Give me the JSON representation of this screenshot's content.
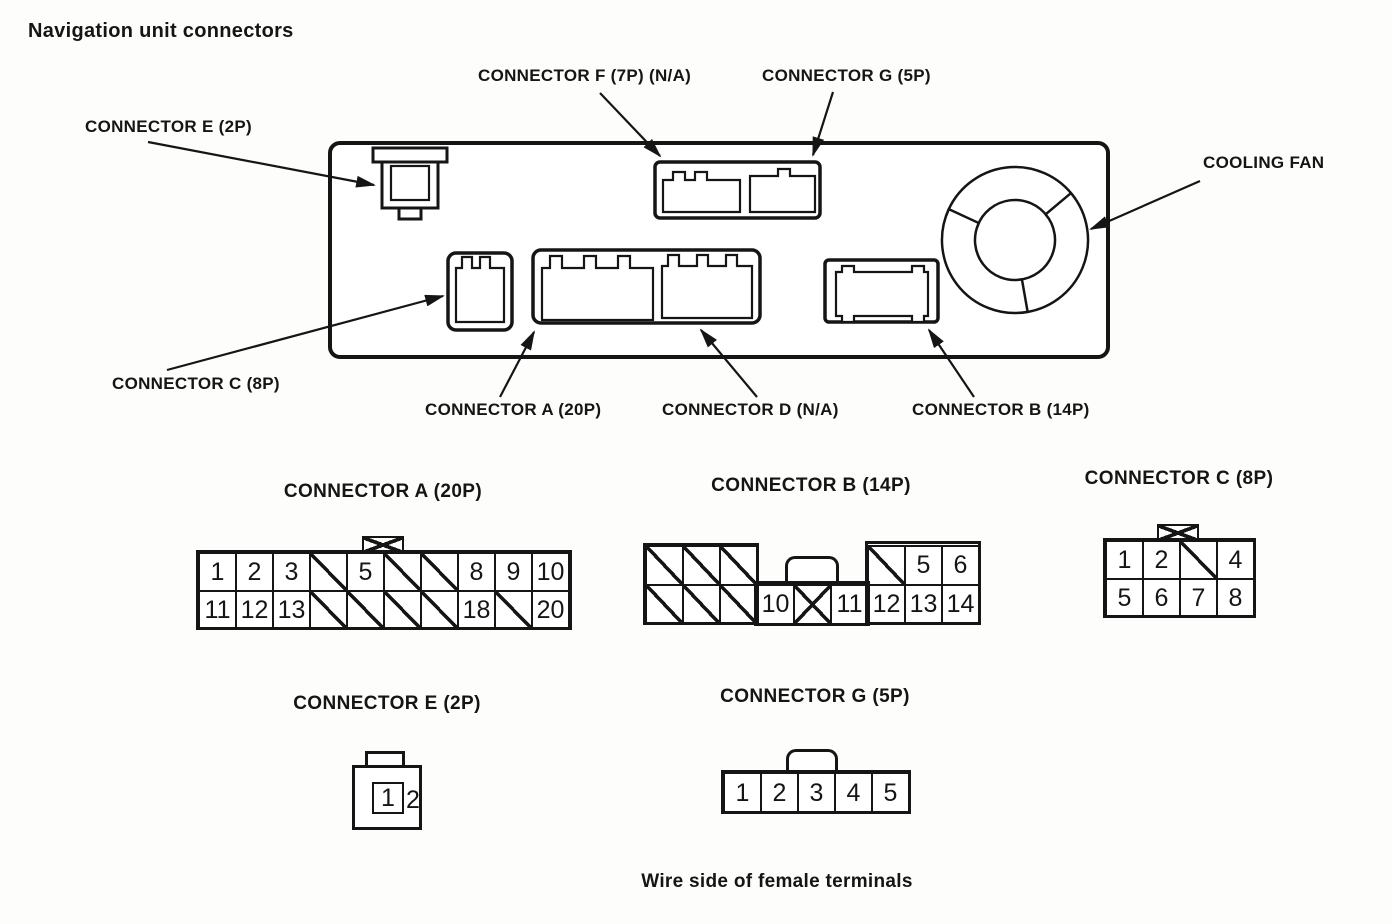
{
  "page_title": "Navigation unit connectors",
  "footer_note": "Wire side of female terminals",
  "unit_diagram": {
    "labels": {
      "e": "CONNECTOR E (2P)",
      "f": "CONNECTOR F (7P) (N/A)",
      "g": "CONNECTOR G (5P)",
      "cooling_fan": "COOLING FAN",
      "c": "CONNECTOR C (8P)",
      "a": "CONNECTOR A (20P)",
      "d": "CONNECTOR D (N/A)",
      "b": "CONNECTOR B (14P)"
    }
  },
  "pinouts": {
    "a": {
      "title": "CONNECTOR A (20P)",
      "rows": [
        [
          "1",
          "2",
          "3",
          "/",
          "5",
          "/",
          "/",
          "8",
          "9",
          "10"
        ],
        [
          "11",
          "12",
          "13",
          "/",
          "/",
          "/",
          "/",
          "18",
          "/",
          "20"
        ]
      ]
    },
    "b": {
      "title": "CONNECTOR B (14P)",
      "rows": [
        [
          "/",
          "/",
          "/",
          null,
          null,
          null,
          "/",
          "5",
          "6"
        ],
        [
          "/",
          "/",
          "/",
          "10",
          "X",
          "11",
          "12",
          "13",
          "14"
        ]
      ]
    },
    "c": {
      "title": "CONNECTOR C (8P)",
      "rows": [
        [
          "1",
          "2",
          "/",
          "4"
        ],
        [
          "5",
          "6",
          "7",
          "8"
        ]
      ]
    },
    "e": {
      "title": "CONNECTOR E (2P)",
      "pins": [
        "1",
        "2"
      ]
    },
    "g": {
      "title": "CONNECTOR G (5P)",
      "rows": [
        [
          "1",
          "2",
          "3",
          "4",
          "5"
        ]
      ]
    }
  }
}
